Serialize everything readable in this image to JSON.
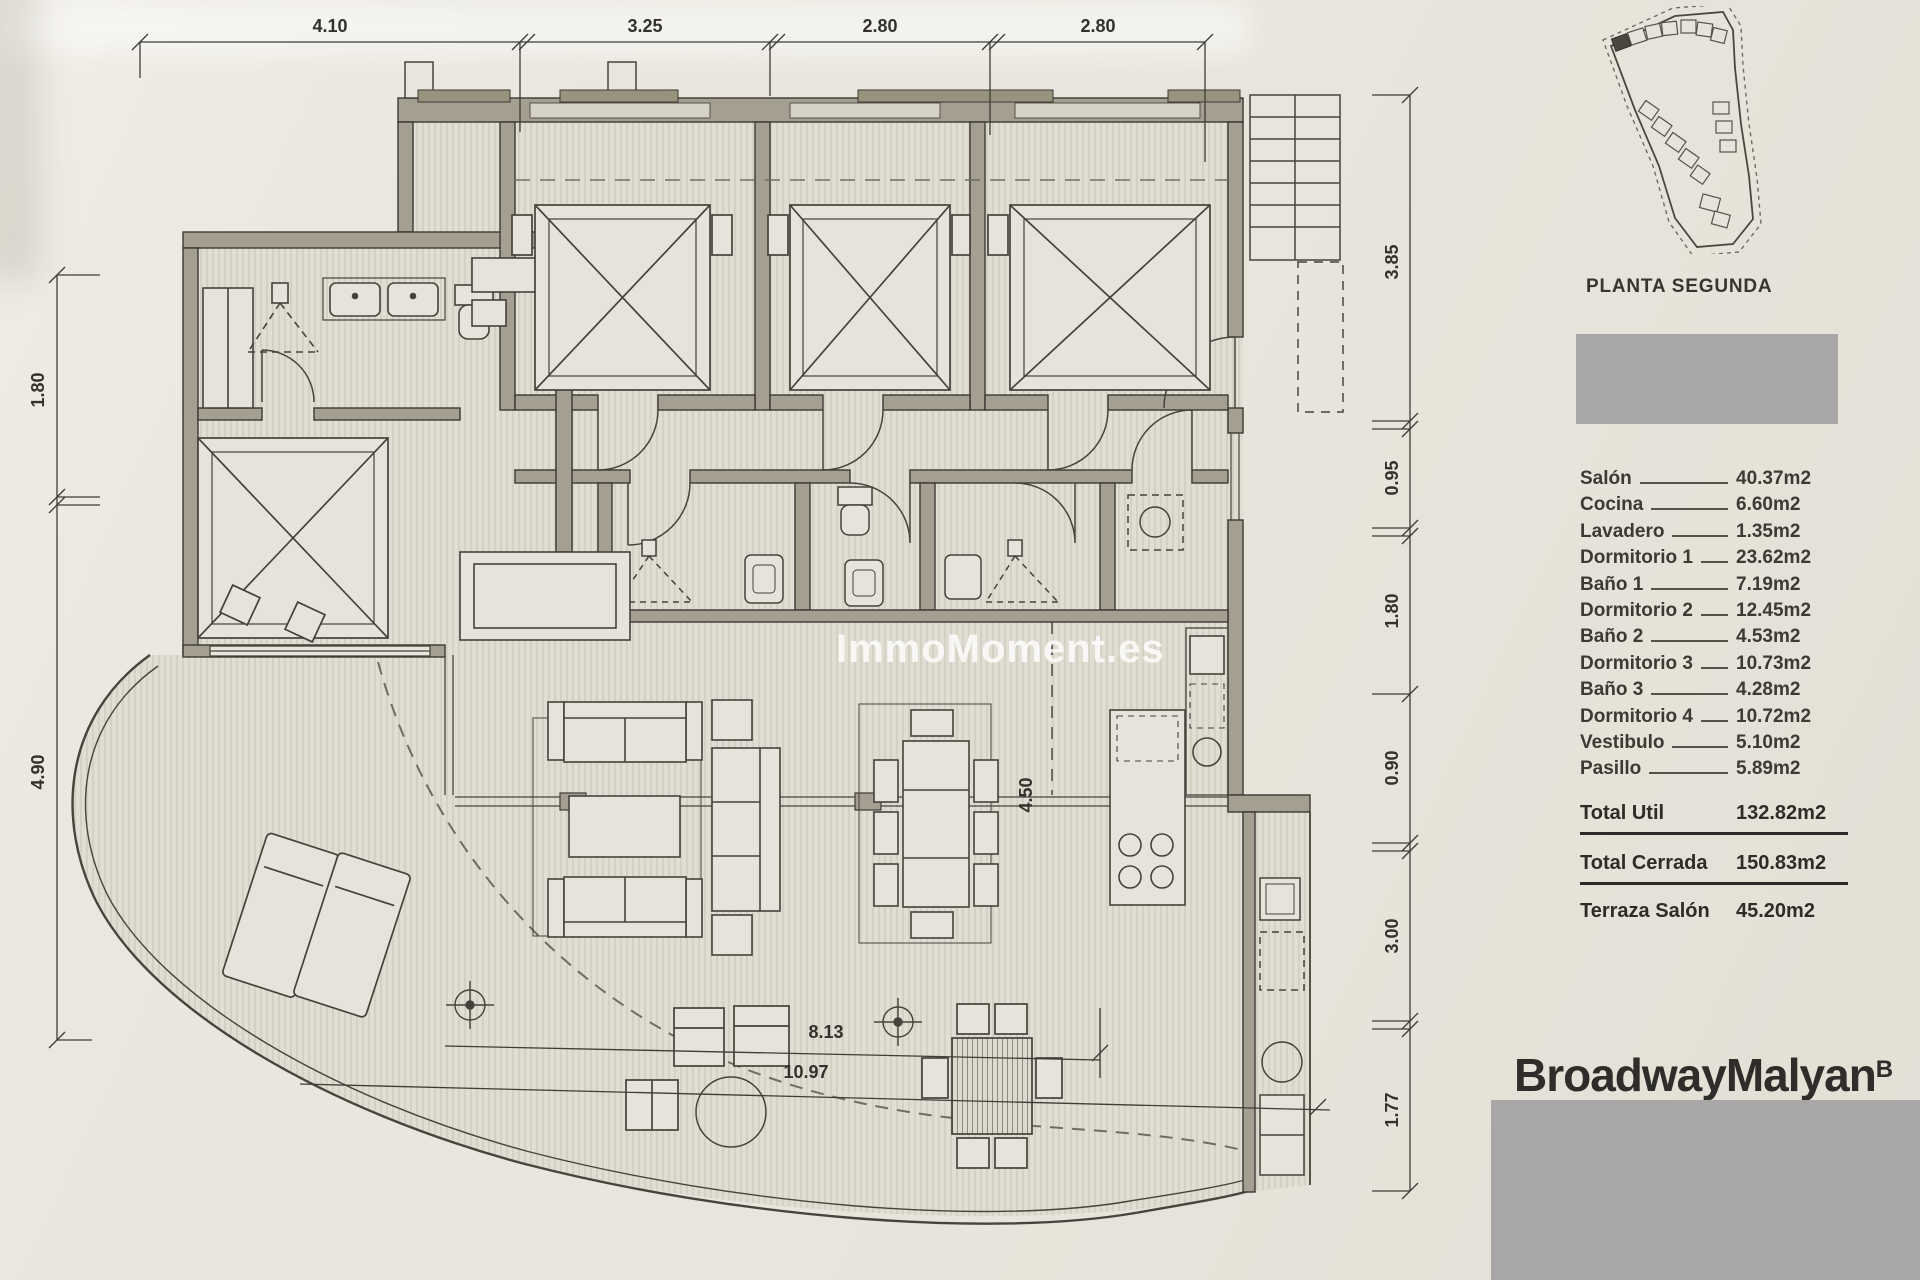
{
  "plan": {
    "watermark": "ImmoMoment.es",
    "dims_top": [
      "4.10",
      "3.25",
      "2.80",
      "2.80"
    ],
    "dims_left": [
      "1.80",
      "4.90"
    ],
    "dims_right": [
      "3.85",
      "0.95",
      "1.80",
      "0.90",
      "3.00",
      "1.77"
    ],
    "dims_inner": {
      "vertical": "4.50",
      "terrace_upper": "8.13",
      "terrace_lower": "10.97"
    }
  },
  "panel": {
    "title": "PLANTA SEGUNDA",
    "rooms": [
      {
        "name": "Salón",
        "area": "40.37m2"
      },
      {
        "name": "Cocina",
        "area": "6.60m2"
      },
      {
        "name": "Lavadero",
        "area": "1.35m2"
      },
      {
        "name": "Dormitorio 1",
        "area": "23.62m2"
      },
      {
        "name": "Baño 1",
        "area": "7.19m2"
      },
      {
        "name": "Dormitorio 2",
        "area": "12.45m2"
      },
      {
        "name": "Baño 2",
        "area": "4.53m2"
      },
      {
        "name": "Dormitorio 3",
        "area": "10.73m2"
      },
      {
        "name": "Baño 3",
        "area": "4.28m2"
      },
      {
        "name": "Dormitorio 4",
        "area": "10.72m2"
      },
      {
        "name": "Vestibulo",
        "area": "5.10m2"
      },
      {
        "name": "Pasillo",
        "area": "5.89m2"
      }
    ],
    "totals": [
      {
        "name": "Total Util",
        "area": "132.82m2"
      },
      {
        "name": "Total Cerrada",
        "area": "150.83m2"
      }
    ],
    "terrace": {
      "name": "Terraza Salón",
      "area": "45.20m2"
    },
    "logo": {
      "text": "BroadwayMalyan",
      "mark": "B"
    }
  }
}
